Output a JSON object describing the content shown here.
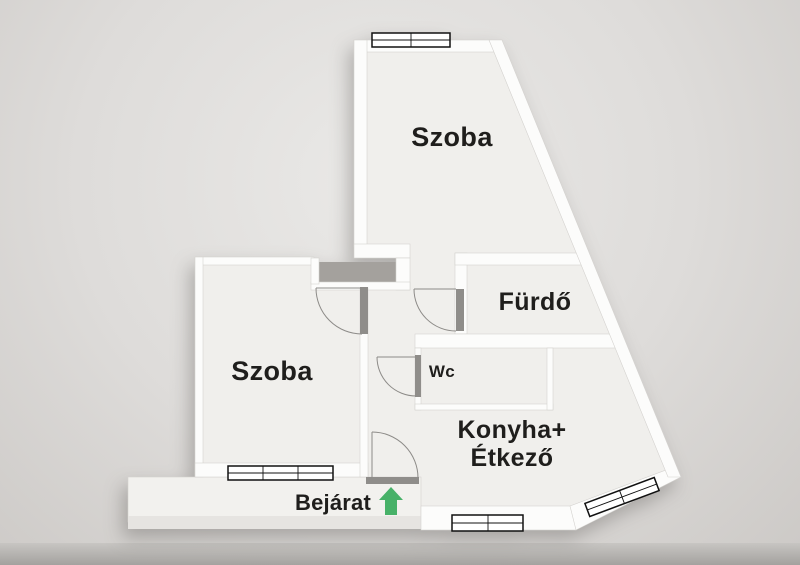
{
  "plan": {
    "rooms": {
      "szoba_top": "Szoba",
      "szoba_left": "Szoba",
      "furdo": "Fürdő",
      "wc": "Wc",
      "konyha_line1": "Konyha+",
      "konyha_line2": "Étkező"
    },
    "entrance": {
      "label": "Bejárat",
      "arrow_direction": "up"
    },
    "colors": {
      "arrow_green": "#47b168",
      "text": "#1f1e1c",
      "wall": "#fcfcfb",
      "floor": "#f0efec",
      "shaft_dark": "#a4a19d",
      "door_jamb": "#8f8d8a",
      "background": "#dedcda"
    }
  }
}
